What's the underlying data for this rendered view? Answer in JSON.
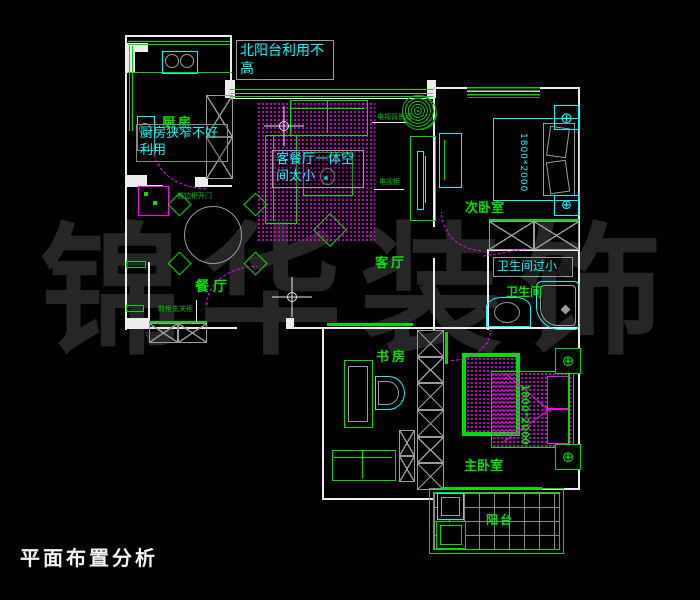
{
  "title": {
    "text": "平面布置分析"
  },
  "watermark": {
    "chars": [
      "锦",
      "华",
      "装",
      "饰"
    ],
    "color": "#262626"
  },
  "colors": {
    "background": "#000000",
    "wall": "#ececec",
    "line_green": "#00dd00",
    "fixture_cyan": "#00ffff",
    "accent_magenta": "#ff00ff",
    "detail_gray": "#9c9c9c",
    "watermark_gray": "#262626"
  },
  "rooms": {
    "kitchen": "厨房",
    "dining": "餐厅",
    "living": "客厅",
    "bedroom2": "次卧室",
    "bathroom": "卫生间",
    "study": "书房",
    "master_bedroom": "主卧室",
    "balcony": "阳台"
  },
  "annotations": {
    "north_balcony": "北阳台利用不高",
    "kitchen": "厨房狭窄不好利用",
    "living": "客餐厅一体空间太小",
    "bathroom": "卫生间过小"
  },
  "small_notes": {
    "dining_cabinet": "餐边柜开门",
    "entry_cabinet": "鞋柜玄关柜",
    "tv_wall": "电视背景墙",
    "tv_stand": "电视柜"
  },
  "dimensions": {
    "bedroom2_bed": "1800*2000",
    "master_bed": "1800*2000"
  }
}
